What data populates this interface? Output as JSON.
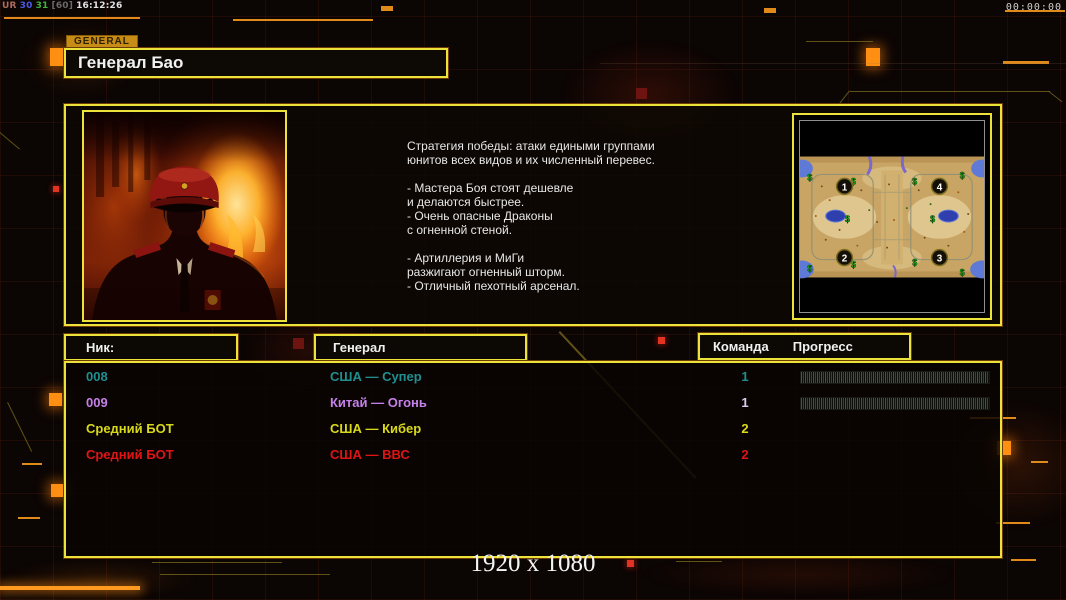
{
  "hud": {
    "debug_tokens": [
      {
        "text": "UR",
        "color": "#b06a5a"
      },
      {
        "text": "30",
        "color": "#4a5ae8"
      },
      {
        "text": "31",
        "color": "#3fb43f"
      },
      {
        "text": "[60]",
        "color": "#6a6a6a"
      },
      {
        "text": "16:12:26",
        "color": "#e2e2e2"
      }
    ],
    "timer": "00:00:00"
  },
  "header": {
    "tab_label": "GENERAL",
    "general_title": "Генерал Бао"
  },
  "strategy": {
    "lines": [
      "Стратегия победы: атаки едиными группами",
      "юнитов всех видов и их численный перевес.",
      "",
      "- Мастера Боя стоят дешевле",
      "и делаются быстрее.",
      "- Очень опасные Драконы",
      "с огненной стеной.",
      "",
      "- Артиллерия и МиГи",
      "разжигают огненный шторм.",
      "- Отличный пехотный арсенал."
    ]
  },
  "minimap": {
    "positions": [
      "1",
      "2",
      "3",
      "4"
    ],
    "supply_symbol": "$"
  },
  "table": {
    "headers": {
      "nick": "Ник:",
      "general": "Генерал",
      "team": "Команда",
      "progress": "Прогресс"
    },
    "rows": [
      {
        "nick": "008",
        "general": "США — Супер",
        "team": "1",
        "color": "#1f8f8f",
        "team_color": "#1f8f8f",
        "has_progress": true
      },
      {
        "nick": "009",
        "general": "Китай — Огонь",
        "team": "1",
        "color": "#c680ea",
        "team_color": "#d9cdf2",
        "has_progress": true
      },
      {
        "nick": "Средний БОТ",
        "general": "США — Кибер",
        "team": "2",
        "color": "#d9d91c",
        "team_color": "#d9d91c",
        "has_progress": false
      },
      {
        "nick": "Средний БОТ",
        "general": "США — ВВС",
        "team": "2",
        "color": "#e01414",
        "team_color": "#e01414",
        "has_progress": false
      }
    ]
  },
  "footer": {
    "resolution": "1920 x 1080"
  },
  "colors": {
    "accent_border": "#ede23a",
    "tab_bg": "#c78c16"
  }
}
